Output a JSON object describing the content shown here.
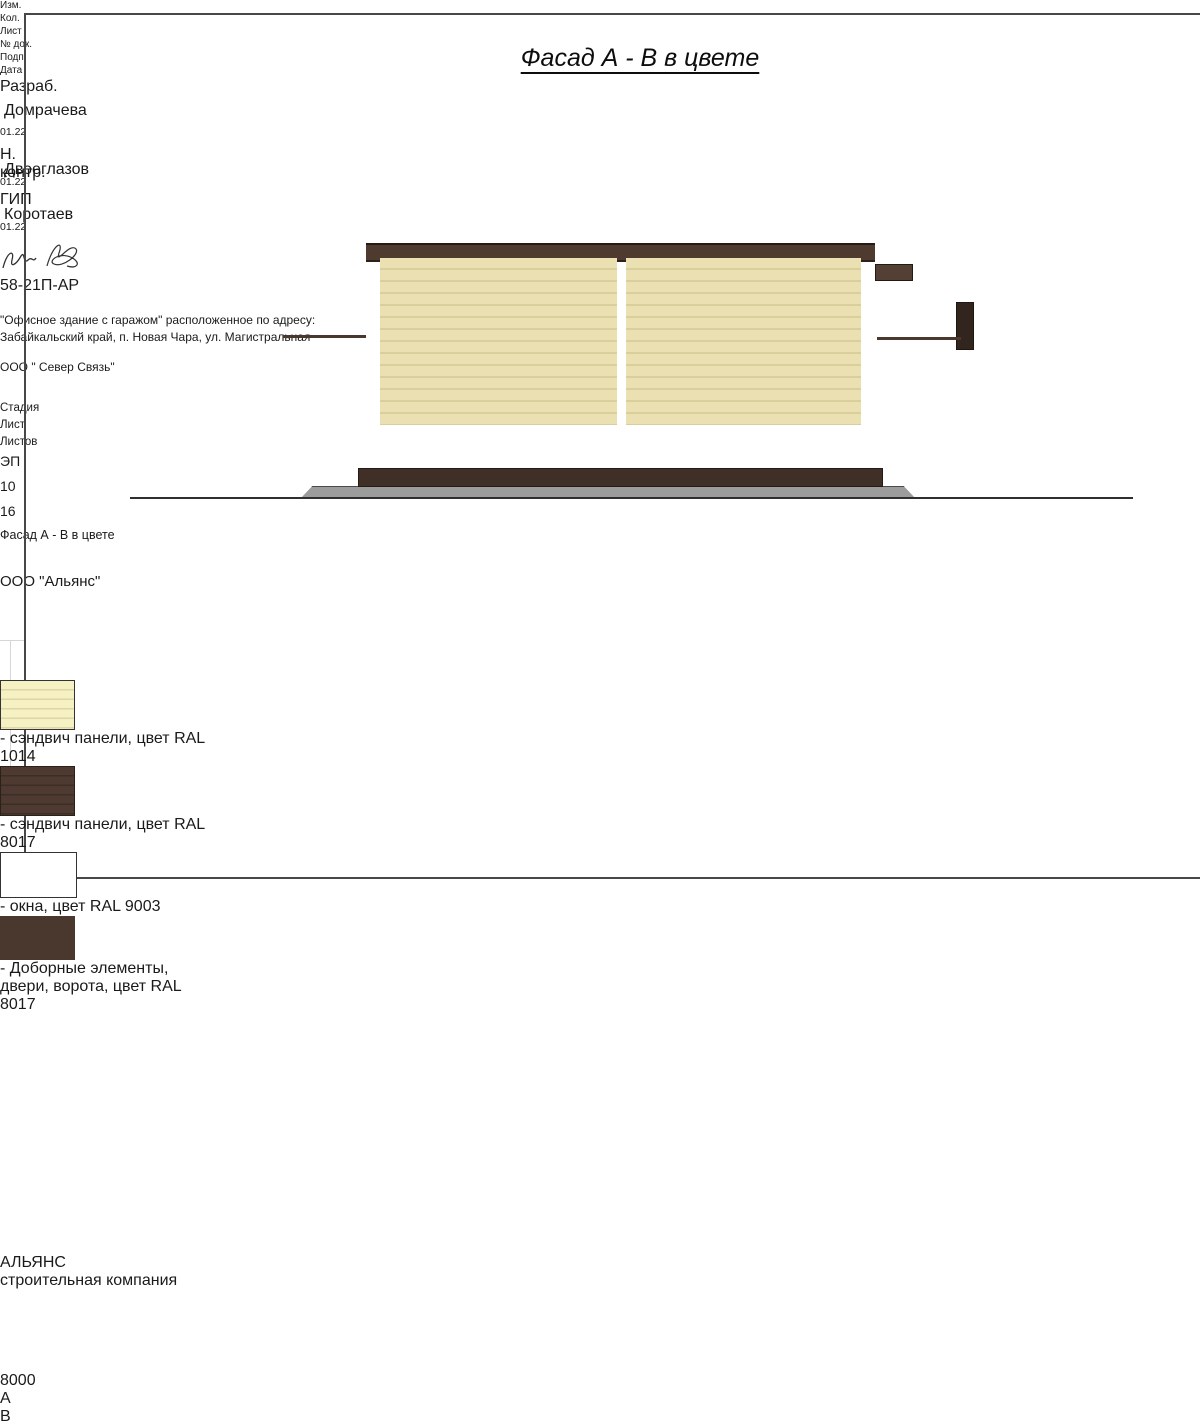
{
  "title": "Фасад А - В в цвете",
  "drawing": {
    "dimension_label": "8000",
    "axis_a": "А",
    "axis_b": "В",
    "watermark_name": "АЛЬЯНС",
    "watermark_subtitle": "строительная компания"
  },
  "legend": {
    "items": [
      {
        "swatch": "cream-striped",
        "label": "- сэндвич панели, цвет RAL 1014"
      },
      {
        "swatch": "brown-striped",
        "label": "- сэндвич панели, цвет RAL 8017"
      },
      {
        "swatch": "white",
        "label": "- окна, цвет RAL 9003"
      },
      {
        "swatch": "dark-brown",
        "label": "- Доборные элементы, двери,\nворота, цвет RAL 8017"
      }
    ]
  },
  "title_block": {
    "doc_number": "58-21П-АР",
    "project_address_line1": "\"Офисное здание с гаражом\" расположенное по адресу:",
    "project_address_line2": "Забайкальский край, п. Новая Чара, ул. Магистральная",
    "rev_columns": [
      "Изм.",
      "Кол.",
      "Лист",
      "№ док.",
      "Подп.",
      "Дата"
    ],
    "signers": [
      {
        "role": "Разраб.",
        "name": "Домрачева",
        "date": "01.22"
      },
      {
        "role": "Н. контр.",
        "name": "Двоеглазов",
        "date": "01.22"
      },
      {
        "role": "ГИП",
        "name": "Коротаев",
        "date": "01.22"
      }
    ],
    "contractor": "ООО \" Север Связь\"",
    "stage_label": "Стадия",
    "sheet_label": "Лист",
    "sheets_label": "Листов",
    "stage_value": "ЭП",
    "sheet_value": "10",
    "sheets_value": "16",
    "drawing_title": "Фасад А - В в цвете",
    "company": "ООО \"Альянс\""
  },
  "colors": {
    "ral_1014_cream": "#e5dbaa",
    "ral_8017_brown": "#4e3a30",
    "ral_9003_white": "#ffffff",
    "foundation_gray": "#9c9c9c"
  }
}
